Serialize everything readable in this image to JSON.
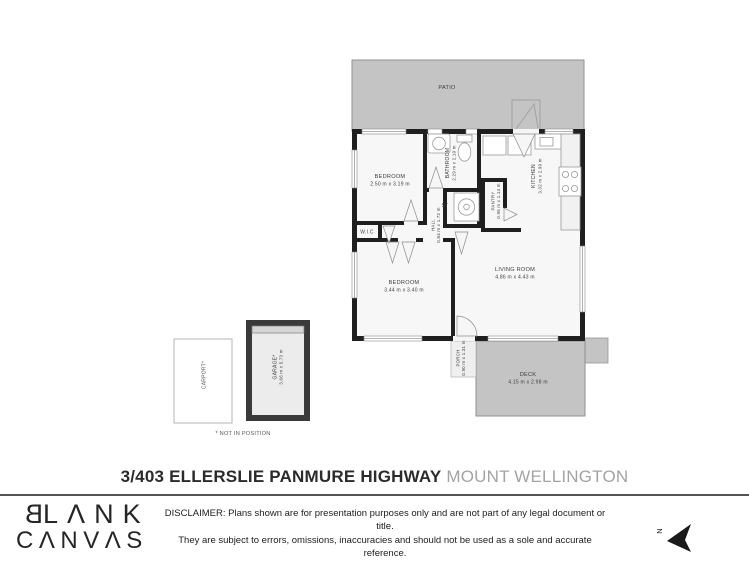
{
  "plan": {
    "patio_label": "PATIO",
    "rooms": {
      "bedroom1": {
        "name": "BEDROOM",
        "dims": "2.50 m x 3.19 m"
      },
      "bathroom": {
        "name": "BATHROOM",
        "dims": "2.29 m x 2.19 m"
      },
      "kitchen": {
        "name": "KITCHEN",
        "dims": "3.32 m x 2.99 m"
      },
      "pantry": {
        "name": "PANTRY",
        "dims": "0.95 m x 1.14 m"
      },
      "store": {
        "name": "ST"
      },
      "hall": {
        "name": "HALL",
        "dims": "0.84 m x 1.72 m"
      },
      "wic": {
        "name": "W.I.C"
      },
      "bedroom2": {
        "name": "BEDROOM",
        "dims": "3.44 m x 3.40 m"
      },
      "living": {
        "name": "LIVING ROOM",
        "dims": "4.86 m x 4.43 m"
      },
      "porch": {
        "name": "PORCH",
        "dims": "0.90 m x 1.31 m"
      },
      "deck": {
        "name": "DECK",
        "dims": "4.15 m x 2.98 m"
      },
      "carport": {
        "name": "CARPORT*"
      },
      "garage": {
        "name": "GARAGE*",
        "dims": "3.66 m x 5.73 m"
      }
    },
    "note": "* NOT IN POSITION",
    "north_label": "N"
  },
  "title": {
    "street": "3/403 ELLERSLIE PANMURE HIGHWAY",
    "suburb": "MOUNT WELLINGTON"
  },
  "footer": {
    "logo_line1_first": "B",
    "logo_line1_rest": "LΛNK",
    "logo_line2": "CΛNVΛS",
    "disclaimer": [
      "DISCLAIMER: Plans shown are for presentation purposes only and are not part of any legal document or title.",
      "They are subject to errors, omissions, inaccuracies and should not be used as a sole and accurate reference.",
      "Interested parties should make their own inquiries using independent sources."
    ]
  },
  "colors": {
    "wall": "#1f1f1f",
    "outdoor_gray": "#c4c4c4",
    "title_accent": "#2b2b2b",
    "title_muted": "#a3a3a3"
  }
}
